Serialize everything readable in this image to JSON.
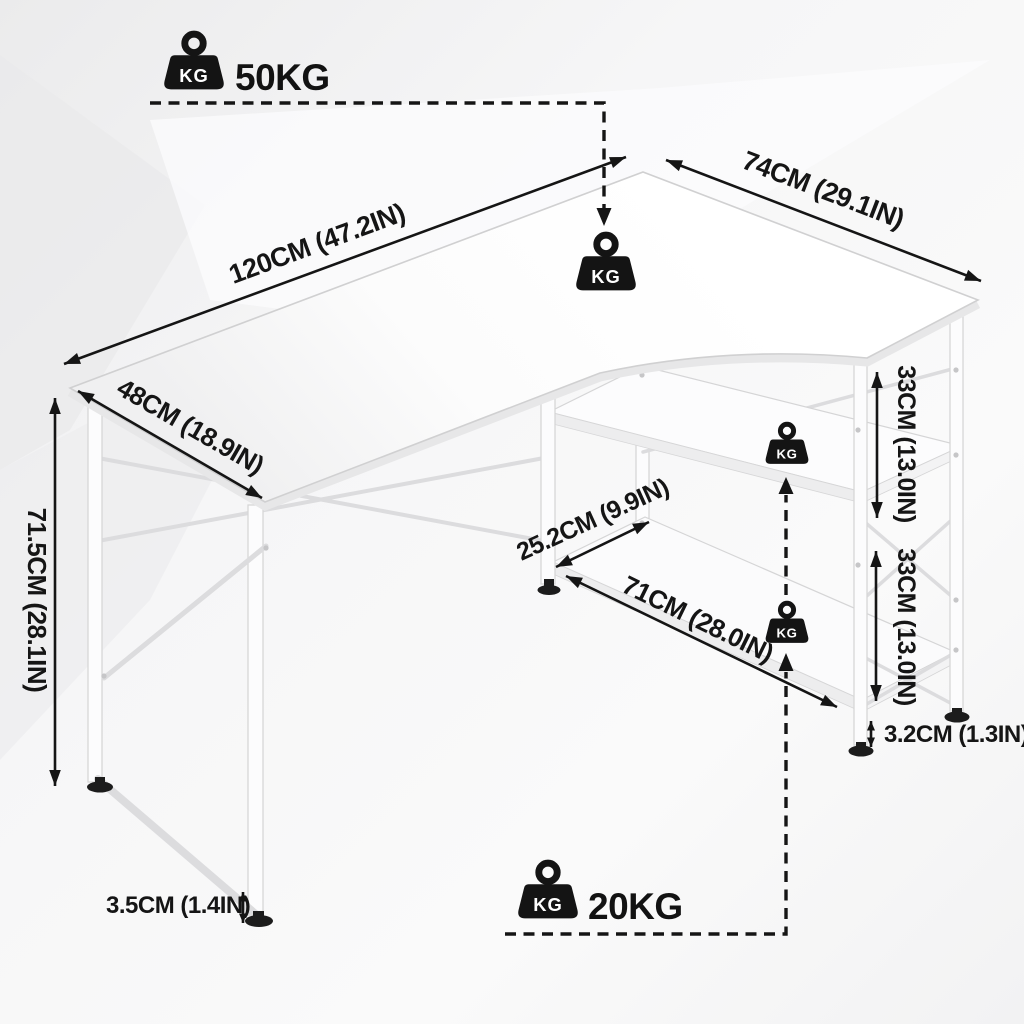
{
  "weight_icon_label": "KG",
  "capacity": {
    "desktop_label": "50KG",
    "shelf_label": "20KG"
  },
  "dimensions": {
    "top_length": "120CM (47.2IN)",
    "top_side": "74CM (29.1IN)",
    "left_depth": "48CM (18.9IN)",
    "height": "71.5CM (28.1IN)",
    "shelf_gap_upper": "33CM (13.0IN)",
    "shelf_gap_lower": "33CM (13.0IN)",
    "board_thickness": "3.2CM (1.3IN)",
    "shelf_width": "25.2CM (9.9IN)",
    "shelf_length": "71CM (28.0IN)",
    "foot_height": "3.5CM (1.4IN)"
  },
  "colors": {
    "annotation": "#151515",
    "furniture_edge": "#d6d6d7",
    "furniture_fill": "#fcfcfd",
    "background": "#f2f2f3"
  }
}
